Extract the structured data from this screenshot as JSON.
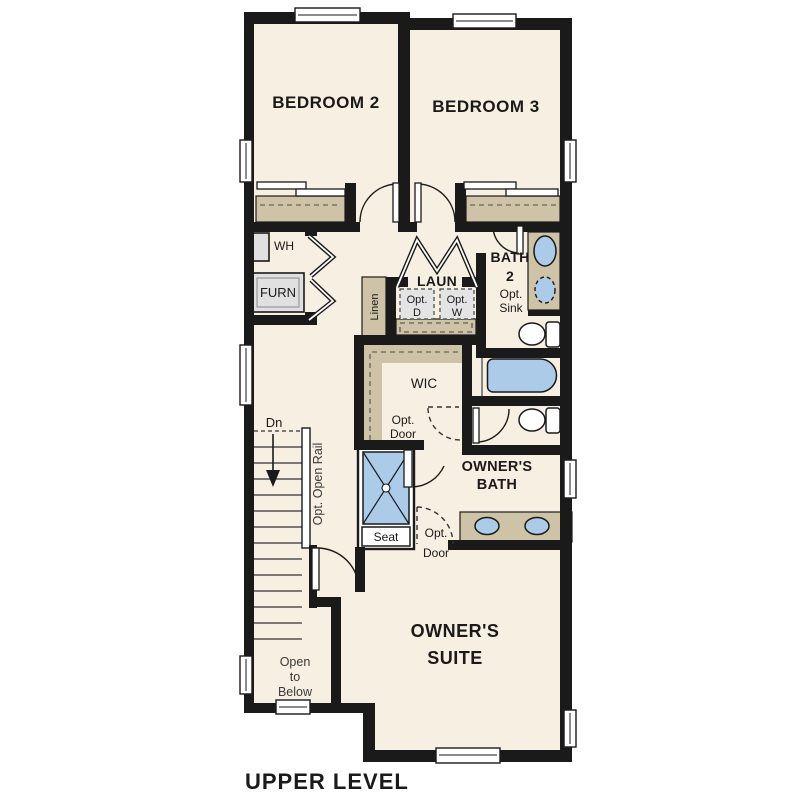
{
  "plan_title": "UPPER LEVEL",
  "colors": {
    "background": "#ffffff",
    "floor": "#f7efe2",
    "wall": "#1a1a1a",
    "cabinetry_tan": "#cfc3a7",
    "fixture_blue": "#abcbe9",
    "equipment_gray": "#e0e0e0"
  },
  "labels": {
    "bedroom2": "BEDROOM 2",
    "bedroom3": "BEDROOM 3",
    "water_heater": "WH",
    "furnace": "FURN",
    "laundry": "LAUN",
    "opt_dryer_1": "Opt.",
    "opt_dryer_2": "D",
    "opt_washer_1": "Opt.",
    "opt_washer_2": "W",
    "linen": "Linen",
    "bath2_1": "BATH",
    "bath2_2": "2",
    "opt_sink_1": "Opt.",
    "opt_sink_2": "Sink",
    "wic": "WIC",
    "wic_opt_door_1": "Opt.",
    "wic_opt_door_2": "Door",
    "stairs_down": "Dn",
    "opt_open_rail": "Opt. Open Rail",
    "owners_bath_1": "OWNER'S",
    "owners_bath_2": "BATH",
    "shower_seat": "Seat",
    "suite_opt_door_1": "Opt.",
    "suite_opt_door_2": "Door",
    "owners_suite_1": "OWNER'S",
    "owners_suite_2": "SUITE",
    "open_below_1": "Open",
    "open_below_2": "to",
    "open_below_3": "Below"
  }
}
